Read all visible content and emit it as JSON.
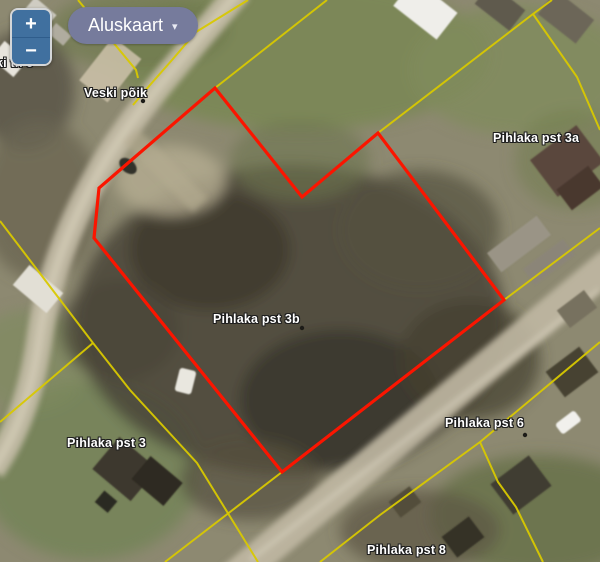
{
  "colors": {
    "highlight_outline": "#fb1500",
    "cadastral_boundary": "#d8c800",
    "basemap_button_bg": "#767b9c",
    "zoom_button_bg": "#40709f"
  },
  "controls": {
    "zoom_in_label": "+",
    "zoom_out_label": "−",
    "basemap_label": "Aluskaart",
    "basemap_caret": "▾"
  },
  "map_labels": [
    {
      "text": "ki tn 9",
      "x": -4,
      "y": 56
    },
    {
      "text": "Veski põik",
      "x": 84,
      "y": 86
    },
    {
      "text": "Pihlaka pst 3a",
      "x": 493,
      "y": 131
    },
    {
      "text": "Pihlaka pst 3b",
      "x": 213,
      "y": 312
    },
    {
      "text": "Pihlaka pst 3",
      "x": 67,
      "y": 436
    },
    {
      "text": "Pihlaka pst 6",
      "x": 445,
      "y": 416
    },
    {
      "text": "Pihlaka pst 8",
      "x": 367,
      "y": 543
    }
  ],
  "highlight_parcel": {
    "points": "215,88 302,197 378,133 504,300 282,472 94,238 99,188"
  },
  "cadastral_lines": [
    "165,562 282,472 504,300 600,228",
    "320,562 380,515 480,442 600,342",
    "480,442 498,482 516,507 543,562",
    "302,197 378,133 533,14 552,0",
    "533,14 577,77 600,130",
    "215,88 327,0",
    "248,0 196,32 172,60 150,85 133,105",
    "78,0 136,70 138,78",
    "0,221 45,280 93,343",
    "93,343 0,422",
    "93,343 130,390 197,463 258,562"
  ]
}
